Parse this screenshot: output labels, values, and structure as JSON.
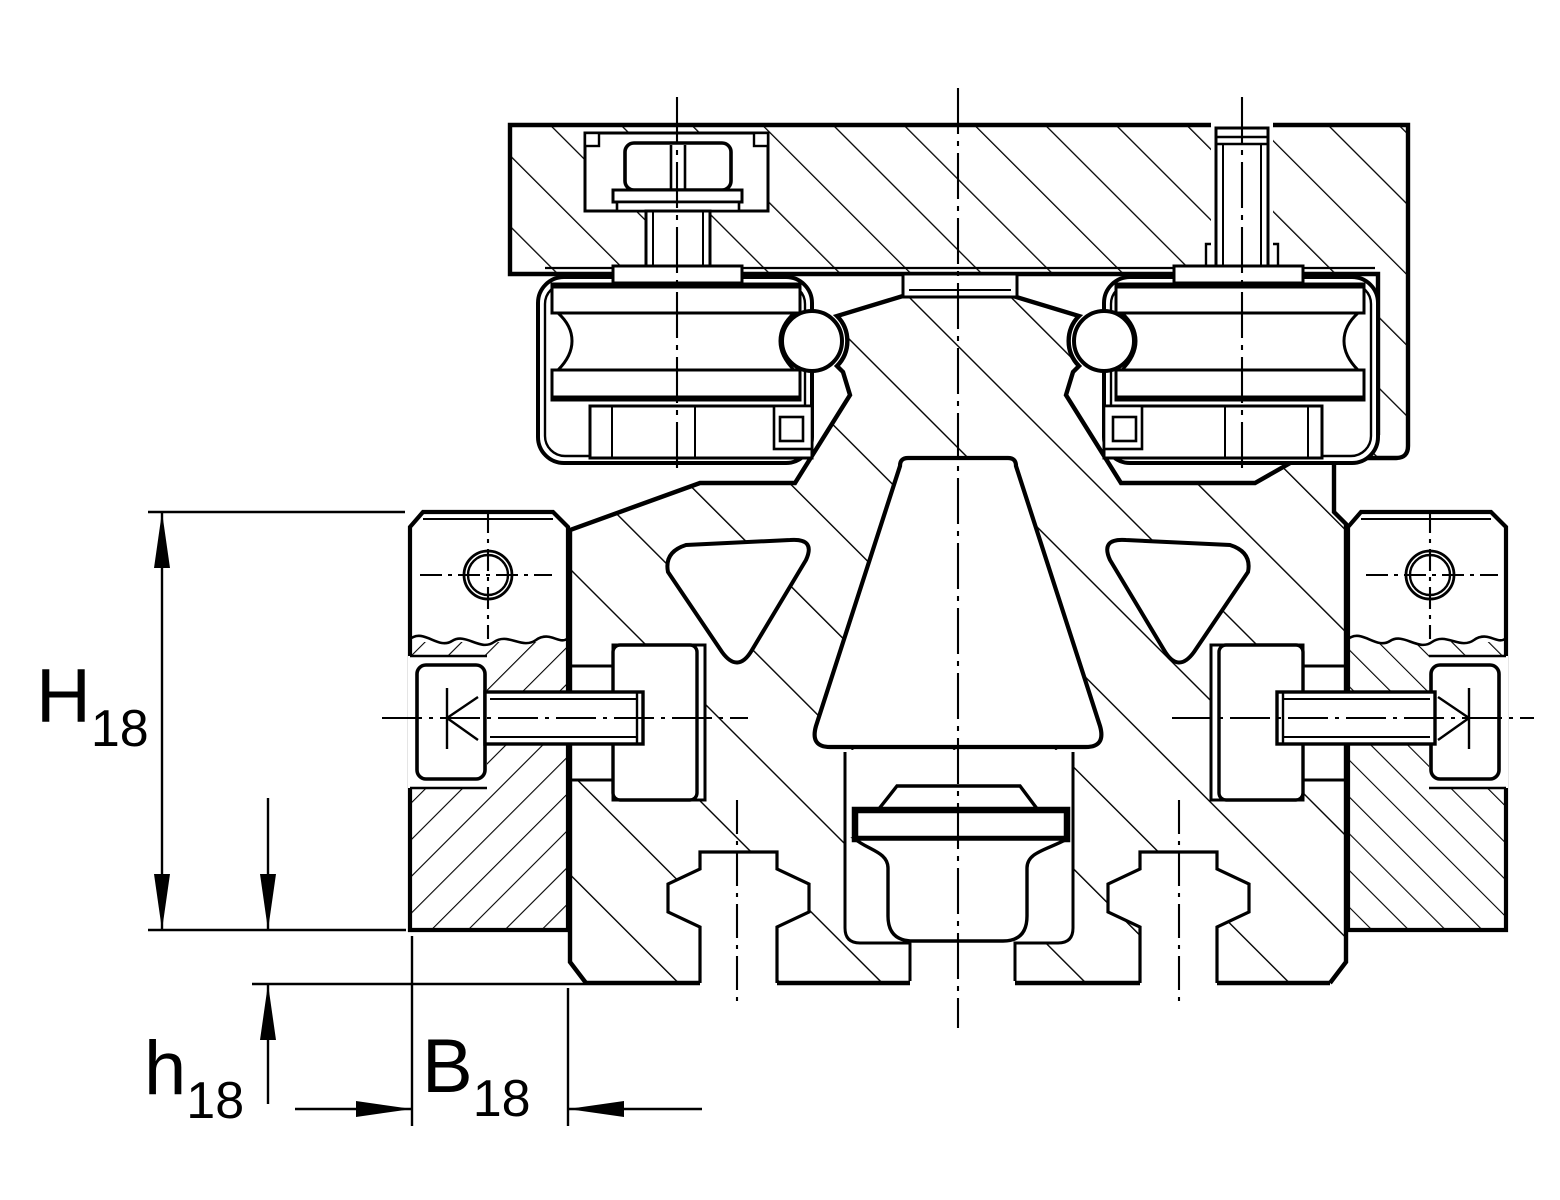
{
  "drawing": {
    "kind": "technical-section-drawing",
    "colors": {
      "line": "#000000",
      "background": "#ffffff"
    },
    "dimensions": {
      "height": {
        "main": "H",
        "sub": "18"
      },
      "offset": {
        "main": "h",
        "sub": "18"
      },
      "width": {
        "main": "B",
        "sub": "18"
      }
    },
    "icons": {
      "hatch_main": "diagonal-hatch-45deg",
      "centerline": "dash-dot-centerline",
      "arrow": "filled-dimension-arrow"
    }
  }
}
